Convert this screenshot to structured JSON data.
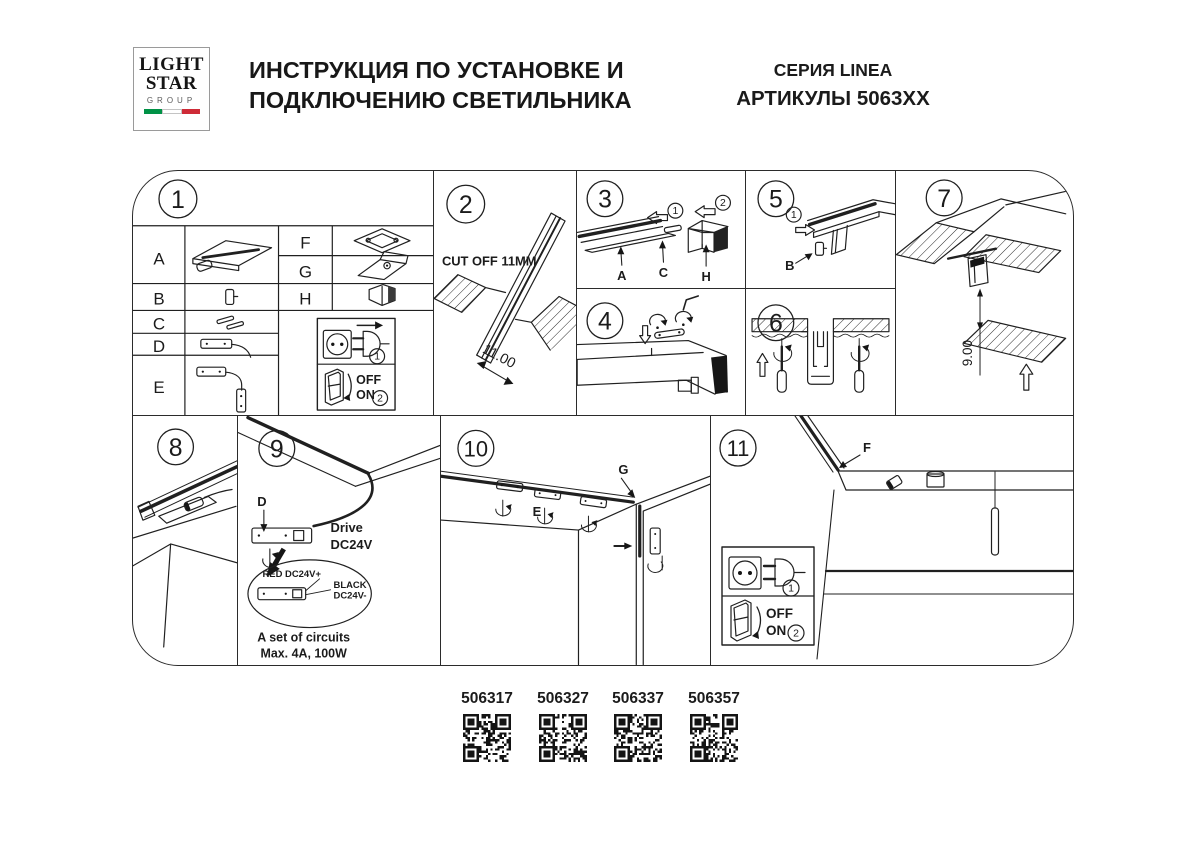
{
  "header": {
    "logo": {
      "word1": "LIGHT",
      "word2": "STAR",
      "word3": "GROUP"
    },
    "title_line1": "ИНСТРУКЦИЯ ПО УСТАНОВКЕ И",
    "title_line2": "ПОДКЛЮЧЕНИЮ СВЕТИЛЬНИКА",
    "series": "СЕРИЯ LINEA",
    "articles": "АРТИКУЛЫ 5063XX"
  },
  "panels": {
    "n1": "1",
    "n2": "2",
    "n3": "3",
    "n4": "4",
    "n5": "5",
    "n6": "6",
    "n7": "7",
    "n8": "8",
    "n9": "9",
    "n10": "10",
    "n11": "11"
  },
  "p1": {
    "a": "A",
    "b": "B",
    "c": "C",
    "d": "D",
    "e": "E",
    "f": "F",
    "g": "G",
    "h": "H"
  },
  "power": {
    "step1": "1",
    "step2": "2",
    "off": "OFF",
    "on": "ON"
  },
  "p2": {
    "cut_off": "CUT OFF 11MM",
    "dim": "11.00"
  },
  "p3": {
    "s1": "1",
    "s2": "2",
    "a": "A",
    "c": "C",
    "h": "H"
  },
  "p5": {
    "s1": "1",
    "b": "B"
  },
  "p7": {
    "dim": "9.00"
  },
  "p9": {
    "d": "D",
    "drive_l1": "Drive",
    "drive_l2": "DC24V",
    "red": "RED DC24V+",
    "black_l1": "BLACK",
    "black_l2": "DC24V-",
    "circ_l1": "A set of circuits",
    "circ_l2": "Max. 4A, 100W"
  },
  "p10": {
    "e": "E",
    "g": "G"
  },
  "p11": {
    "f": "F"
  },
  "qr": {
    "items": [
      "506317",
      "506327",
      "506337",
      "506357"
    ]
  },
  "colors": {
    "line": "#202020",
    "flag_green": "#009246",
    "flag_red": "#ce2b37"
  }
}
